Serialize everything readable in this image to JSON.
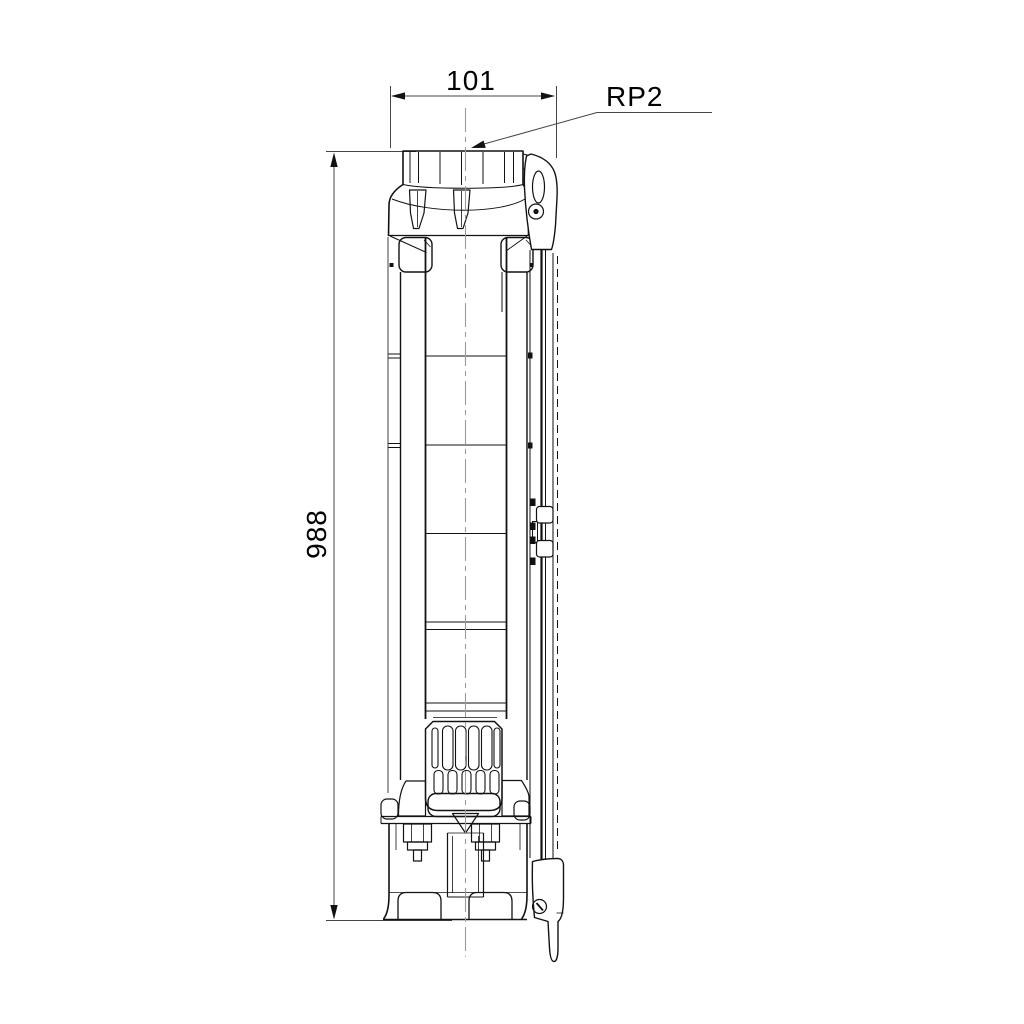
{
  "colors": {
    "background": "#ffffff",
    "line": "#121212",
    "dimension": "#454545",
    "centerline": "#9b9b9b",
    "text": "#000000"
  },
  "drawing": {
    "width_dimension": {
      "value": "101"
    },
    "height_dimension": {
      "value": "988"
    },
    "thread_label": {
      "value": "RP2"
    }
  }
}
